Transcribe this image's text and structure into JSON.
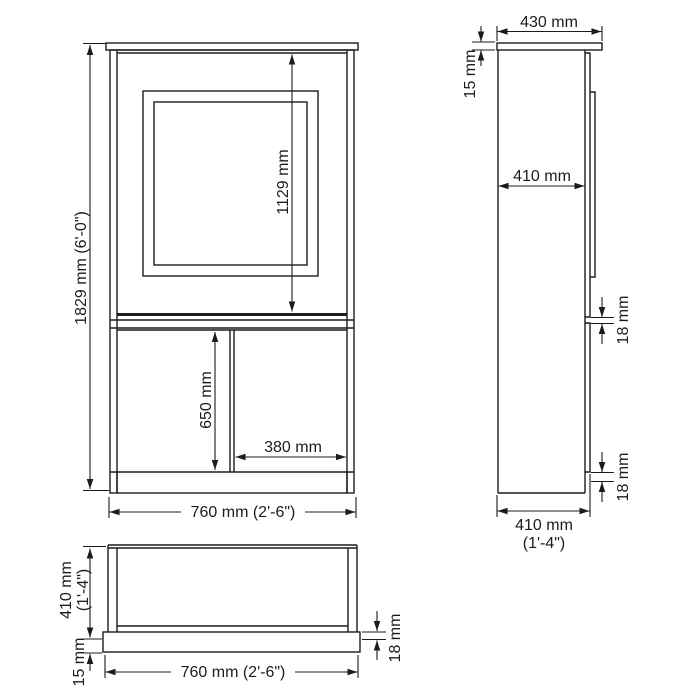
{
  "front_view": {
    "height": "1829 mm (6'-0\")",
    "upper_door_height": "1129 mm",
    "lower_door_height": "650 mm",
    "lower_door_width": "380 mm",
    "width": "760 mm (2'-6\")"
  },
  "side_view": {
    "top_width": "430 mm",
    "top_thickness": "15 mm",
    "inner_depth": "410 mm",
    "shelf_thickness": "18 mm",
    "bottom_thickness": "18 mm",
    "depth": "410 mm",
    "depth_imperial": "(1'-4\")"
  },
  "plan_view": {
    "depth": "410 mm",
    "depth_imperial": "(1'-4\")",
    "front_overhang": "15 mm",
    "width": "760 mm (2'-6\")",
    "panel_thickness": "18 mm"
  },
  "colors": {
    "line": "#1c1c1c",
    "background": "#ffffff"
  }
}
